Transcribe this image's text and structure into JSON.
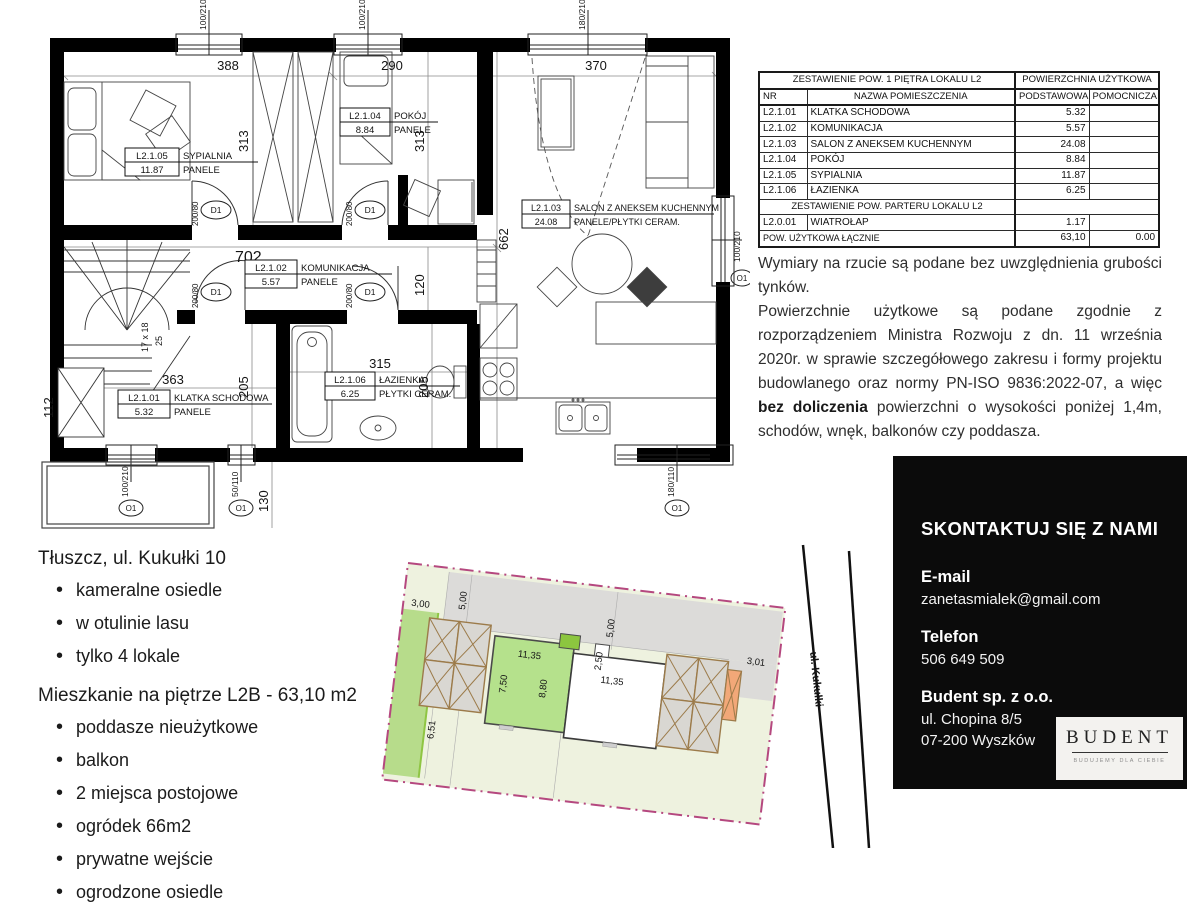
{
  "floor_plan": {
    "rooms": [
      {
        "nr": "L2.1.05",
        "name": "SYPIALNIA",
        "area": "11.87",
        "floor": "PANELE"
      },
      {
        "nr": "L2.1.04",
        "name": "POKÓJ",
        "area": "8.84",
        "floor": "PANELE"
      },
      {
        "nr": "L2.1.03",
        "name": "SALON Z ANEKSEM KUCHENNYM",
        "area": "24.08",
        "floor": "PANELE/PŁYTKI CERAM."
      },
      {
        "nr": "L2.1.02",
        "name": "KOMUNIKACJA",
        "area": "5.57",
        "floor": "PANELE"
      },
      {
        "nr": "L2.1.01",
        "name": "KLATKA SCHODOWA",
        "area": "5.32",
        "floor": "PANELE"
      },
      {
        "nr": "L2.1.06",
        "name": "ŁAZIENKA",
        "area": "6.25",
        "floor": "PŁYTKI CERAM."
      }
    ],
    "dims": {
      "syp_w": "388",
      "pok_w": "290",
      "sal_w": "370",
      "syp_h": "313",
      "pok_h": "313",
      "corridor_w": "702",
      "sal_h": "662",
      "nook": "120",
      "stairs_w": "363",
      "bath_w": "315",
      "bath_h_l": "205",
      "bath_h_r": "205",
      "shaft": "112",
      "balcony": "130",
      "stairs_note": "17 x 18",
      "stairs_depth": "25"
    },
    "windows": {
      "top1": "100/210",
      "top2": "100/210",
      "top3": "180/210",
      "bottom1": "100/210",
      "bottom2": "50/110",
      "bottom3": "180/110",
      "right1": "100/210"
    },
    "door_mark": "D1",
    "door_size": "200/80",
    "opening_mark": "O1"
  },
  "area_table": {
    "header_group_left": "ZESTAWIENIE POW. 1 PIĘTRA LOKALU L2",
    "header_group_right": "POWIERZCHNIA UŻYTKOWA",
    "col_nr": "NR",
    "col_name": "NAZWA POMIESZCZENIA",
    "col_primary": "PODSTAWOWA",
    "col_aux": "POMOCNICZA",
    "rows": [
      {
        "nr": "L2.1.01",
        "name": "KLATKA SCHODOWA",
        "primary": "5.32",
        "aux": ""
      },
      {
        "nr": "L2.1.02",
        "name": "KOMUNIKACJA",
        "primary": "5.57",
        "aux": ""
      },
      {
        "nr": "L2.1.03",
        "name": "SALON Z ANEKSEM KUCHENNYM",
        "primary": "24.08",
        "aux": ""
      },
      {
        "nr": "L2.1.04",
        "name": "POKÓJ",
        "primary": "8.84",
        "aux": ""
      },
      {
        "nr": "L2.1.05",
        "name": "SYPIALNIA",
        "primary": "11.87",
        "aux": ""
      },
      {
        "nr": "L2.1.06",
        "name": "ŁAZIENKA",
        "primary": "6.25",
        "aux": ""
      }
    ],
    "section2": "ZESTAWIENIE POW. PARTERU LOKALU L2",
    "rows2": [
      {
        "nr": "L2.0.01",
        "name": "WIATROŁAP",
        "primary": "1.17",
        "aux": ""
      }
    ],
    "total_label": "POW. UŻYTKOWA ŁĄCZNIE",
    "total_primary": "63,10",
    "total_aux": "0.00"
  },
  "notes": {
    "p1": "Wymiary na rzucie są podane bez uwzględnienia grubości tynków.",
    "p2_before": "Powierzchnie użytkowe są podane zgodnie z rozporządzeniem Ministra Rozwoju z dn. 11 września 2020r. w sprawie szczegółowego zakresu i formy projektu budowlanego oraz normy PN-ISO 9836:2022-07, a więc ",
    "p2_bold": "bez doliczenia",
    "p2_after": " powierzchni o wysokości poniżej 1,4m, schodów, wnęk, balkonów czy poddasza."
  },
  "listing": {
    "location": "Tłuszcz, ul. Kukułki 10",
    "features": [
      "kameralne osiedle",
      "w otulinie lasu",
      "tylko 4 lokale"
    ],
    "unit": "Mieszkanie na piętrze L2B - 63,10 m2",
    "unit_features": [
      "poddasze nieużytkowe",
      "balkon",
      "2 miejsca postojowe",
      "ogródek 66m2",
      "prywatne wejście",
      "ogrodzone osiedle"
    ]
  },
  "site_plan": {
    "street": "ul. Kukułki",
    "dims": {
      "d300": "3,00",
      "d500a": "5,00",
      "d500b": "5,00",
      "d250": "2,50",
      "d301": "3,01",
      "d1135a": "11,35",
      "d750": "7,50",
      "d880": "8,80",
      "d1135b": "11,35",
      "d651": "6,51"
    },
    "colors": {
      "boundary": "#b5487f",
      "garden": "#b7dc8b",
      "unit": "#b5e18c",
      "gray": "#dcdbd9",
      "orange": "#f2a878"
    }
  },
  "contact": {
    "title": "SKONTAKTUJ SIĘ Z NAMI",
    "email_label": "E-mail",
    "email": "zanetasmialek@gmail.com",
    "phone_label": "Telefon",
    "phone": "506 649 509",
    "company": "Budent sp. z o.o.",
    "address1": "ul. Chopina 8/5",
    "address2": "07-200 Wyszków",
    "logo_text": "BUDENT",
    "logo_tagline": "BUDUJEMY DLA CIEBIE"
  }
}
